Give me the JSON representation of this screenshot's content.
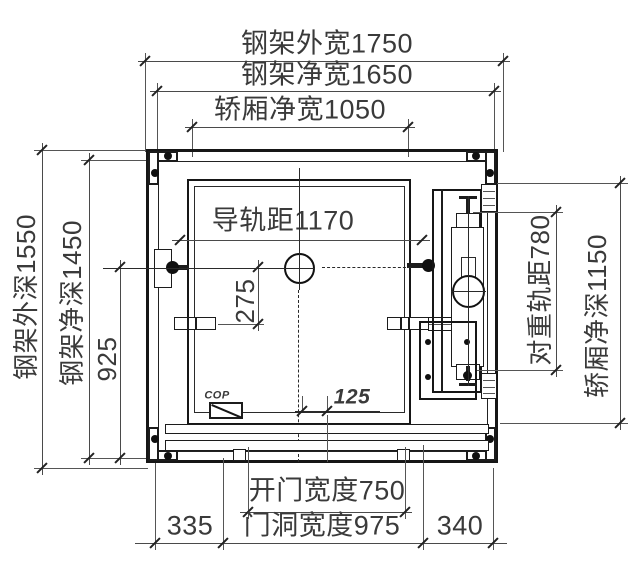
{
  "labels": {
    "frame_outer_width": "钢架外宽1750",
    "frame_clear_width": "钢架净宽1650",
    "car_clear_width": "轿厢净宽1050",
    "guide_rail_distance": "导轨距1170",
    "dim_275": "275",
    "dim_925": "925",
    "frame_outer_depth": "钢架外深1550",
    "frame_clear_depth": "钢架净深1450",
    "cw_rail_distance": "对重轨距780",
    "car_clear_depth": "轿厢净深1150",
    "dim_125": "125",
    "cop": "COP",
    "door_opening_width": "开门宽度750",
    "door_hole_width": "门洞宽度975",
    "dim_335": "335",
    "dim_340": "340"
  },
  "colors": {
    "background": "#ffffff",
    "drawing_line": "#1c1c1c",
    "dimension_line": "#4a4a4a",
    "text": "#3a3a3a"
  }
}
